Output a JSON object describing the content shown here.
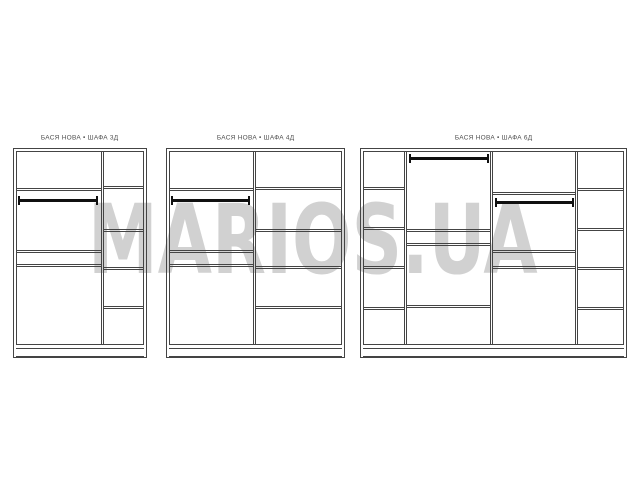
{
  "watermark": {
    "text": "MARIOS.UA",
    "color": "#d1d1d1"
  },
  "diagram": {
    "line_color": "#444444",
    "rod_color": "#101010",
    "label_color": "#4f4f4f",
    "wardrobes": [
      {
        "name": "shafa-3d",
        "label": "БАСЯ НОВА • ШАФА 3Д",
        "box": {
          "x": 13,
          "y": 148,
          "w": 134,
          "h": 210
        },
        "dividers": [
          88
        ],
        "sections": [
          {
            "x0": 3,
            "x1": 88,
            "shelves": [
              40,
              102,
              116
            ],
            "rod": {
              "y": 51,
              "x0": 5,
              "x1": 85
            }
          },
          {
            "x0": 91,
            "x1": 131,
            "shelves": [
              38,
              81,
              119,
              158
            ]
          }
        ]
      },
      {
        "name": "shafa-4d",
        "label": "БАСЯ НОВА • ШАФА 4Д",
        "box": {
          "x": 166,
          "y": 148,
          "w": 179,
          "h": 210
        },
        "dividers": [
          87
        ],
        "sections": [
          {
            "x0": 3,
            "x1": 87,
            "shelves": [
              40,
              102,
              116
            ],
            "rod": {
              "y": 51,
              "x0": 5,
              "x1": 84
            }
          },
          {
            "x0": 90,
            "x1": 176,
            "shelves": [
              39,
              81,
              118,
              158
            ]
          }
        ]
      },
      {
        "name": "shafa-6d",
        "label": "БАСЯ НОВА • ШАФА 6Д",
        "box": {
          "x": 360,
          "y": 148,
          "w": 267,
          "h": 210
        },
        "dividers": [
          44,
          130,
          215
        ],
        "sections": [
          {
            "x0": 3,
            "x1": 44,
            "shelves": [
              39,
              79,
              118,
              159
            ]
          },
          {
            "x0": 47,
            "x1": 130,
            "shelves": [
              81,
              95,
              157
            ],
            "rod": {
              "y": 9,
              "x0": 49,
              "x1": 129
            }
          },
          {
            "x0": 133,
            "x1": 215,
            "shelves": [
              44,
              102,
              118
            ],
            "rod": {
              "y": 53,
              "x0": 135,
              "x1": 214
            }
          },
          {
            "x0": 218,
            "x1": 264,
            "shelves": [
              40,
              80,
              119,
              159
            ]
          }
        ]
      }
    ]
  }
}
